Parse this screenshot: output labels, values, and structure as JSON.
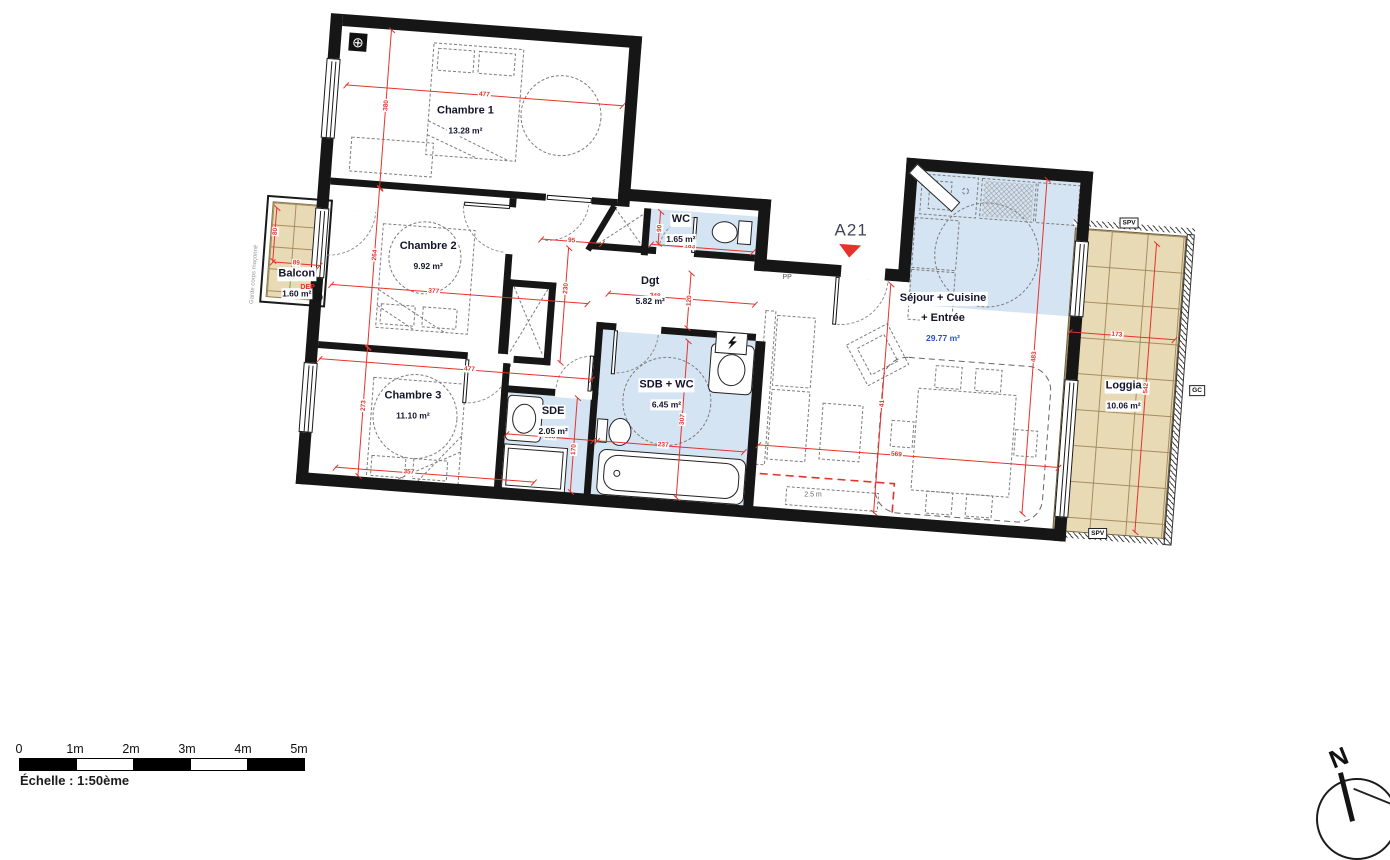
{
  "apartment_id": "A21",
  "rooms": [
    {
      "name": "Chambre 1",
      "area": "13.28 m²",
      "x": 130,
      "y": 96
    },
    {
      "name": "Chambre 2",
      "area": "9.92 m²",
      "x": 103,
      "y": 234
    },
    {
      "name": "Chambre 3",
      "area": "11.10 m²",
      "x": 99,
      "y": 384
    },
    {
      "name": "WC",
      "area": "1.65 m²",
      "x": 353,
      "y": 188
    },
    {
      "name": "Dgt",
      "area": "5.82 m²",
      "x": 327,
      "y": 252
    },
    {
      "name": "SDB + WC",
      "area": "6.45 m²",
      "x": 351,
      "y": 354
    },
    {
      "name": "SDE",
      "area": "2.05 m²",
      "x": 240,
      "y": 389
    },
    {
      "name": "Séjour + Cuisine",
      "name2": "+ Entrée",
      "area": "29.77 m²",
      "x": 621,
      "y": 257,
      "areaColor": "#2a52c8"
    },
    {
      "name": "Balcon",
      "area": "1.60 m²",
      "x": -26,
      "y": 271
    },
    {
      "name": "Loggia",
      "area": "10.06 m²",
      "x": 807,
      "y": 321
    }
  ],
  "dims": [
    {
      "t": "477",
      "x": 8,
      "y": 70,
      "len": 278,
      "o": "h",
      "lp": 50
    },
    {
      "t": "377",
      "x": 8,
      "y": 270,
      "len": 258,
      "o": "h",
      "lp": 40
    },
    {
      "t": "89",
      "x": -52,
      "y": 252,
      "len": 48,
      "o": "h",
      "lp": 50
    },
    {
      "t": "477",
      "x": 2,
      "y": 345,
      "len": 274,
      "o": "h",
      "lp": 55
    },
    {
      "t": "357",
      "x": 26,
      "y": 452,
      "len": 200,
      "o": "h",
      "lp": 37
    },
    {
      "t": "183",
      "x": 324,
      "y": 206,
      "len": 103,
      "o": "h",
      "lp": 38
    },
    {
      "t": "95",
      "x": 214,
      "y": 209,
      "len": 62,
      "o": "h",
      "lp": 50
    },
    {
      "t": "348",
      "x": 285,
      "y": 258,
      "len": 148,
      "o": "h",
      "lp": 32
    },
    {
      "t": "237",
      "x": 285,
      "y": 406,
      "len": 148,
      "o": "h",
      "lp": 45
    },
    {
      "t": "155",
      "x": 194,
      "y": 406,
      "len": 88,
      "o": "h",
      "lp": 50
    },
    {
      "t": "569",
      "x": 446,
      "y": 398,
      "len": 302,
      "o": "h",
      "lp": 46
    },
    {
      "t": "173",
      "x": 748,
      "y": 262,
      "len": 106,
      "o": "h",
      "lp": 45
    },
    {
      "t": "380",
      "x": 49,
      "y": 12,
      "len": 159,
      "o": "v",
      "lp": 48
    },
    {
      "t": "264",
      "x": 49,
      "y": 171,
      "len": 160,
      "o": "v",
      "lp": 42
    },
    {
      "t": "273",
      "x": 49,
      "y": 331,
      "len": 129,
      "o": "v",
      "lp": 45
    },
    {
      "t": "80",
      "x": -52,
      "y": 198,
      "len": 54,
      "o": "v",
      "lp": 45
    },
    {
      "t": "90",
      "x": 331,
      "y": 173,
      "len": 33,
      "o": "v",
      "lp": 50
    },
    {
      "t": "230",
      "x": 242,
      "y": 216,
      "len": 116,
      "o": "v",
      "lp": 35
    },
    {
      "t": "120",
      "x": 366,
      "y": 232,
      "len": 56,
      "o": "v",
      "lp": 50
    },
    {
      "t": "307",
      "x": 368,
      "y": 300,
      "len": 158,
      "o": "v",
      "lp": 50
    },
    {
      "t": "170",
      "x": 262,
      "y": 365,
      "len": 95,
      "o": "v",
      "lp": 55
    },
    {
      "t": "483",
      "x": 714,
      "y": 112,
      "len": 336,
      "o": "v",
      "lp": 53
    },
    {
      "t": "41",
      "x": 566,
      "y": 228,
      "len": 230,
      "o": "v",
      "lp": 52
    },
    {
      "t": "542",
      "x": 828,
      "y": 168,
      "len": 290,
      "o": "v",
      "lp": 50
    }
  ],
  "labels": {
    "entrance_door": "PP",
    "drain": "DEP",
    "railing_note": "Garde corps maçonné",
    "spv": "SPV",
    "gc": "GC",
    "tv_zone": "2.5 m",
    "north": "N"
  },
  "scalebar": {
    "ticks": [
      "0",
      "1m",
      "2m",
      "3m",
      "4m",
      "5m"
    ],
    "caption": "Échelle : 1:50ème"
  },
  "colors": {
    "wall": "#161616",
    "dimension_red": "#e5332c",
    "wet_room_blue": "#d5e4f3",
    "outdoor_tan": "#e9dab6",
    "sejour_area_blue": "#2a52c8",
    "triangle_red": "#e5332c"
  }
}
